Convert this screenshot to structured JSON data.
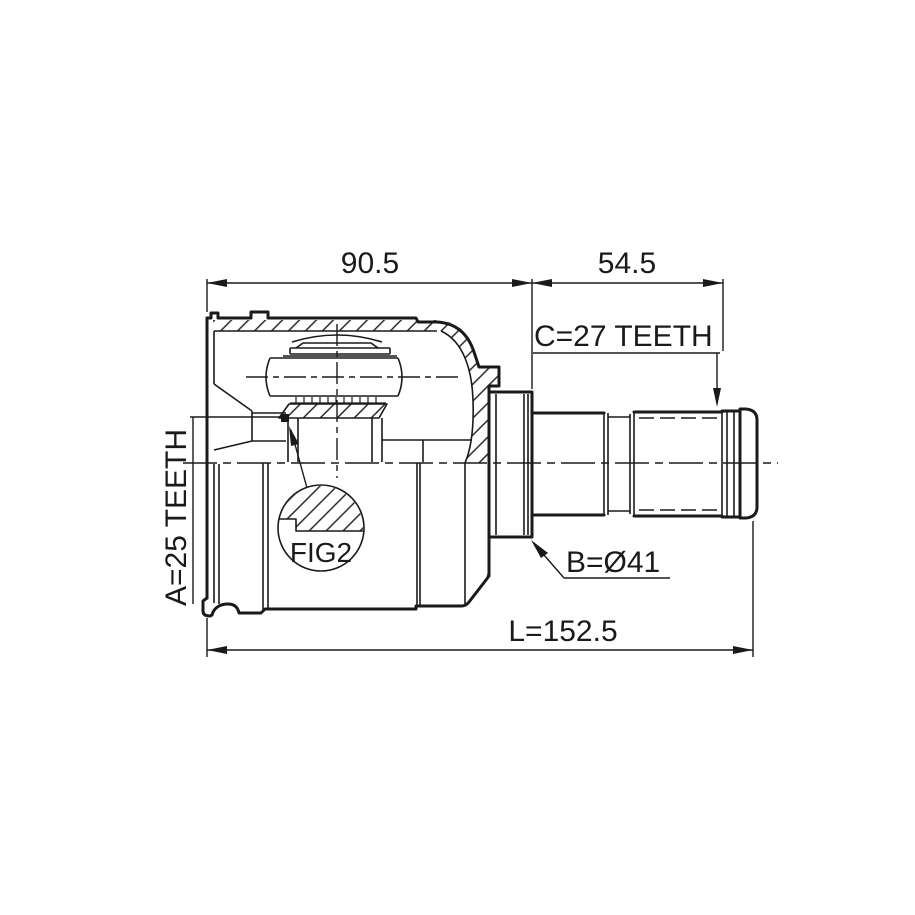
{
  "figure": {
    "type": "cv-joint-technical-drawing",
    "background": "#ffffff",
    "line_color": "#1a1a1a",
    "labels": {
      "housing_width": "90.5",
      "stub_length": "54.5",
      "outer_spline": "C=27 TEETH",
      "inner_spline": "A=25 TEETH",
      "body_diameter": "B=Ø41",
      "overall_length": "L=152.5",
      "detail_ref": "FIG2"
    }
  }
}
